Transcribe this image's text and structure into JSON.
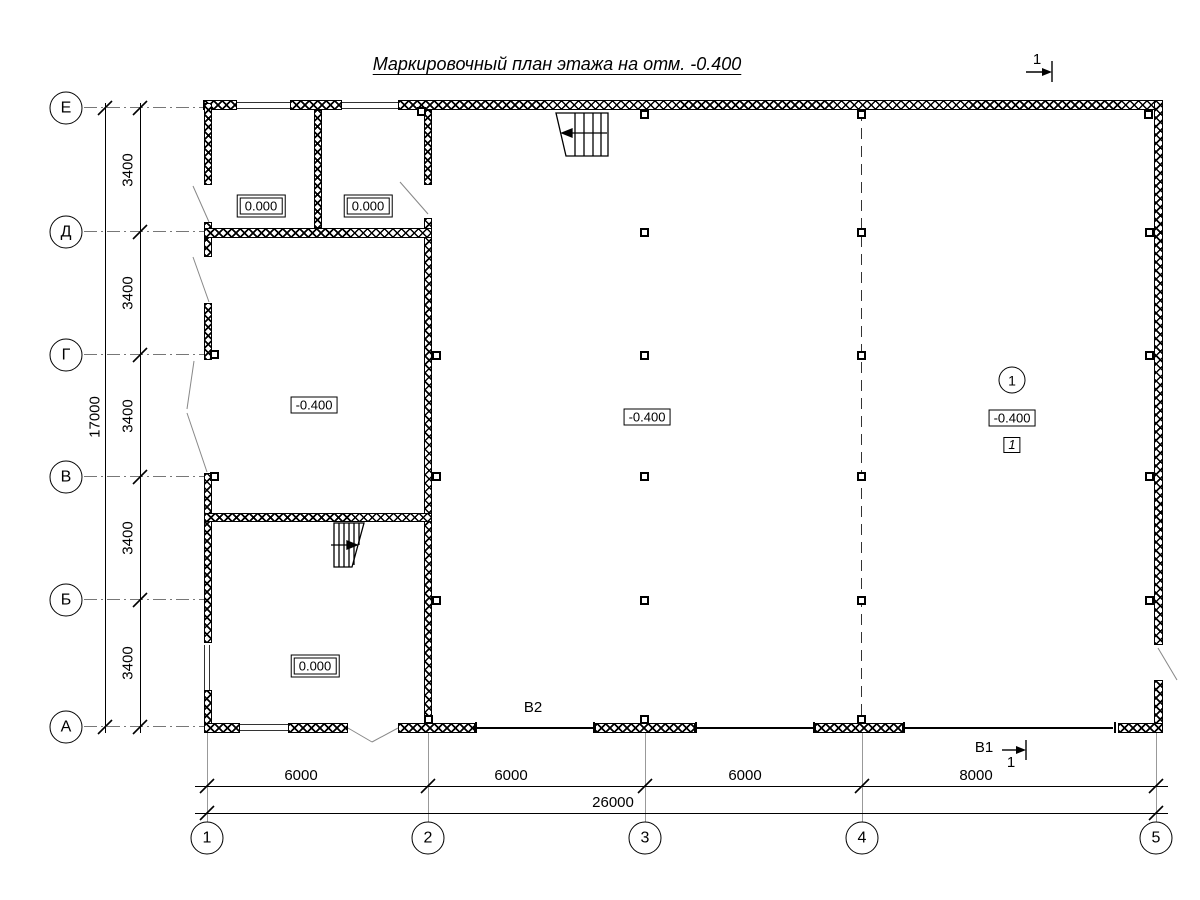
{
  "title": "Маркировочный план этажа на отм. -0.400",
  "axes": {
    "rows": [
      "Е",
      "Д",
      "Г",
      "В",
      "Б",
      "А"
    ],
    "cols": [
      "1",
      "2",
      "3",
      "4",
      "5"
    ]
  },
  "dims": {
    "left": [
      "3400",
      "3400",
      "3400",
      "3400",
      "3400"
    ],
    "left_total": "17000",
    "bottom": [
      "6000",
      "6000",
      "6000",
      "8000"
    ],
    "bottom_total": "26000"
  },
  "elevations": [
    "0.000",
    "0.000",
    "-0.400",
    "-0.400",
    "-0.400",
    "0.000"
  ],
  "marks": {
    "section_top": "1",
    "view_b1": "В1",
    "view_b1_num": "1",
    "view_b2": "В2",
    "room_number": "1",
    "room_type": "1"
  },
  "colors": {
    "line": "#000000",
    "grid": "#777777"
  }
}
